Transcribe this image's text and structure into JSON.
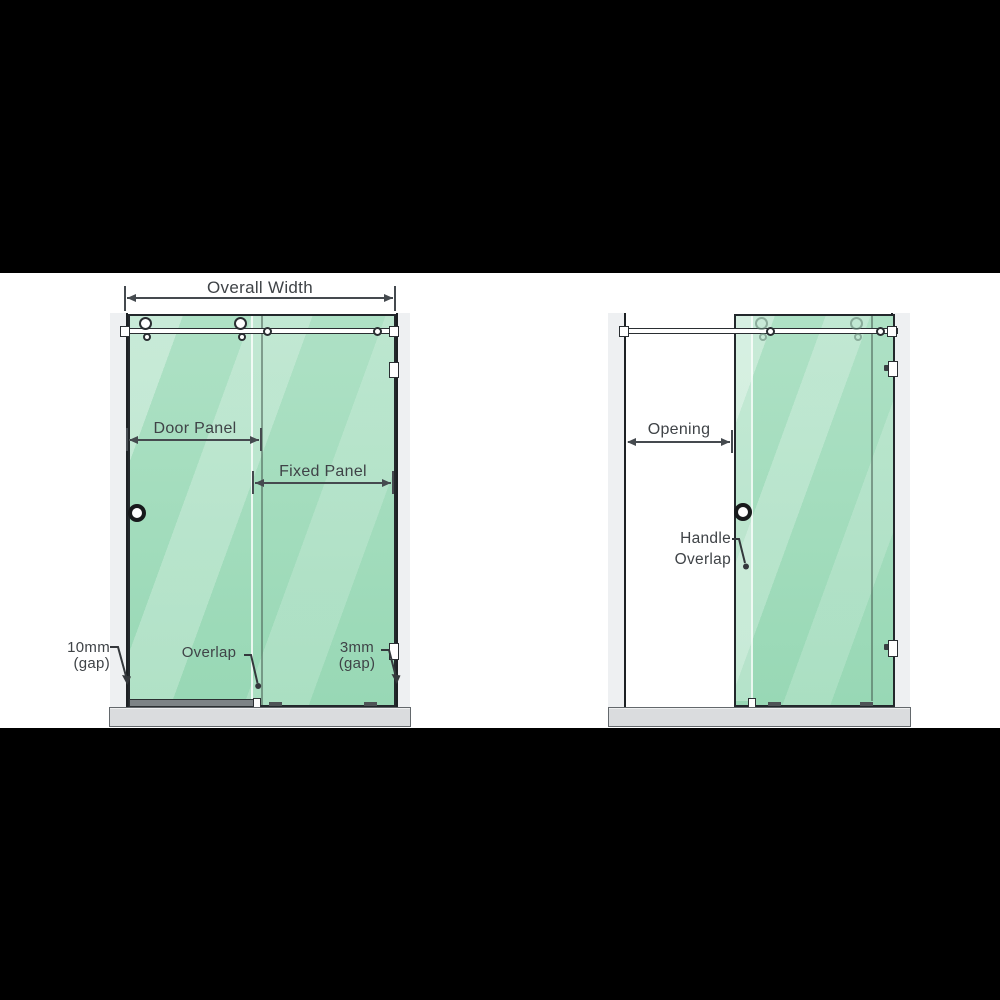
{
  "closed_view": {
    "labels": {
      "overall_width": "Overall Width",
      "door_panel": "Door Panel",
      "fixed_panel": "Fixed Panel",
      "gap_left_line1": "10mm",
      "gap_left_line2": "(gap)",
      "overlap": "Overlap",
      "gap_right_line1": "3mm",
      "gap_right_line2": "(gap)"
    }
  },
  "open_view": {
    "labels": {
      "opening": "Opening",
      "handle_overlap_line1": "Handle",
      "handle_overlap_line2": "Overlap"
    }
  },
  "colors": {
    "glass_light": "#aee1c5",
    "glass_dark": "#98d8b5",
    "frame": "#23282c",
    "label_text": "#3f4347",
    "dimension": "#454a4f",
    "wall": "#eef0f2",
    "floor": "#dadcde",
    "band": "#000000"
  }
}
